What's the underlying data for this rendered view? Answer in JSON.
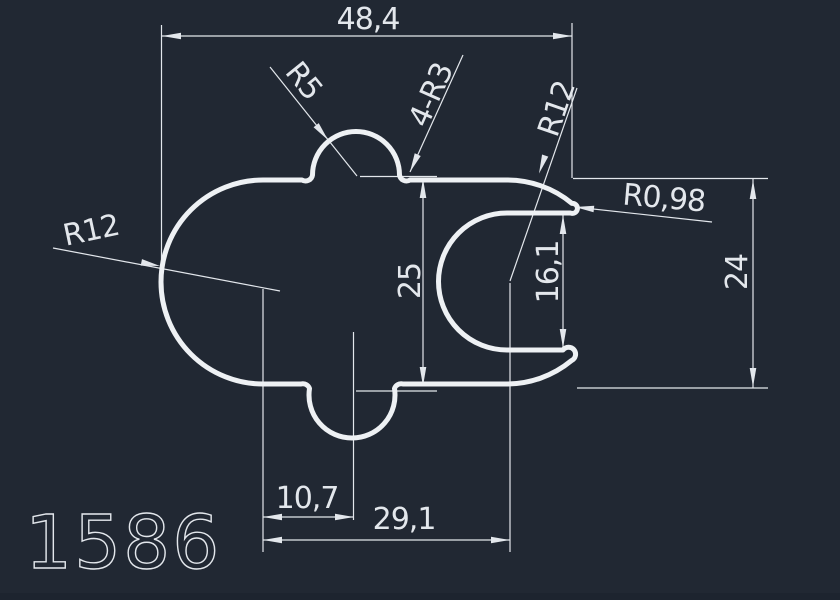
{
  "drawing": {
    "part_number": "1586",
    "dims": {
      "overall_width": "48,4",
      "body_height": "25",
      "opening_height": "16,1",
      "right_height": "24",
      "offset_small": "10,7",
      "offset_large": "29,1"
    },
    "radii": {
      "top_bump": "R5",
      "corner_fillets": "4-R3",
      "left_body": "R12",
      "right_socket": "R12",
      "lip_tip": "R0,98"
    },
    "colors": {
      "background": "#212833",
      "line": "#e3e7ec",
      "profile": "#eef1f4"
    }
  }
}
